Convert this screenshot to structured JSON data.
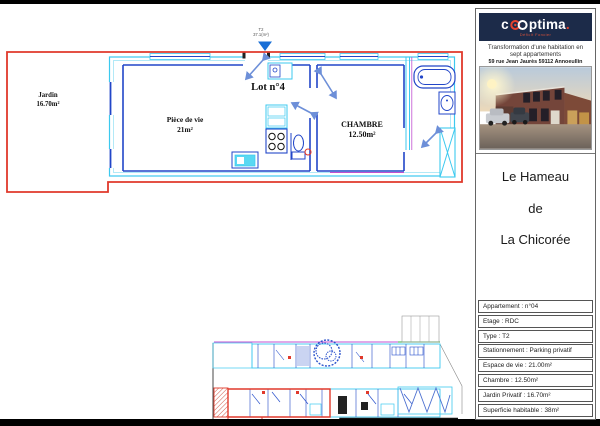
{
  "plan": {
    "marker": {
      "line1": "T2",
      "line2": "37.1(m²)"
    },
    "labels": {
      "jardin_name": "Jardin",
      "jardin_area": "16.70m²",
      "piece_name": "Pièce de vie",
      "piece_area": "21m²",
      "lot": "Lot n°4",
      "chambre_name": "CHAMBRE",
      "chambre_area": "12.50m²"
    },
    "colors": {
      "lot_outline_red": "#e0392b",
      "wall_cyan": "#3cc9ef",
      "wall_blue": "#2246c8",
      "door_arrow_blue": "#6d8fd8",
      "accent_magenta": "#c050d0",
      "accent_green": "#3fae3f"
    }
  },
  "sidebar": {
    "logo": {
      "brand_prefix": "c",
      "brand_rest": "ptima",
      "brand_period": ".",
      "tagline": "Déficit Foncier",
      "bg": "#1c2b49",
      "accent": "#e8432d"
    },
    "subtitle": "Transformation d'une habitation en sept appartements",
    "address": "59 rue Jean Jaurès 59112 Annoeullin",
    "title_lines": [
      "Le Hameau",
      "de",
      "La Chicorée"
    ],
    "info_rows": [
      "Appartement : n°04",
      "Etage : RDC",
      "Type : T2",
      "Stationnement : Parking privatif",
      "Espace de vie : 21.00m²",
      "Chambre : 12.50m²",
      "Jardin Privatif : 16.70m²",
      "Superficie habitable : 38m²"
    ]
  }
}
